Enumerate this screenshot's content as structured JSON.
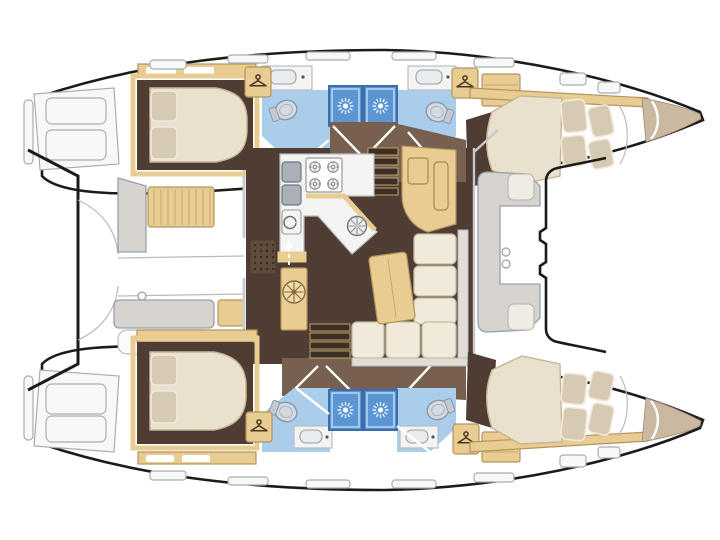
{
  "plan": {
    "title": "Catamaran interior layout plan - top view, bow to the right",
    "vessel_type": "sailing catamaran, 4-cabin / 4-bathroom layout",
    "orientation": {
      "bow": "right",
      "stern": "left",
      "top_hull": "port",
      "bottom_hull": "starboard"
    },
    "rooms": [
      {
        "id": "cabin-aft-port",
        "name": "Aft cabin (port hull)",
        "features": [
          "island double bed",
          "two pillows",
          "wardrobe",
          "hull windows"
        ]
      },
      {
        "id": "bathroom-aft-port",
        "name": "Aft bathroom (port hull)",
        "features": [
          "shower stall",
          "toilet",
          "washbasin"
        ]
      },
      {
        "id": "bathroom-fwd-port",
        "name": "Forward bathroom (port hull)",
        "features": [
          "shower stall",
          "toilet",
          "washbasin"
        ]
      },
      {
        "id": "cabin-fwd-port",
        "name": "Forward cabin (port hull)",
        "features": [
          "double bed",
          "four pillows",
          "wardrobe",
          "shelving",
          "forepeak locker"
        ]
      },
      {
        "id": "salon",
        "name": "Salon and galley",
        "features": [
          "L-shaped galley counter",
          "4-burner stove",
          "double sink",
          "round sink",
          "sideboard/fridge cabinet",
          "L-shaped sofa",
          "dining table",
          "companionway stairs to each hull",
          "sliding-door entry with floor grate"
        ]
      },
      {
        "id": "cabin-aft-starboard",
        "name": "Aft cabin (starboard hull)",
        "features": [
          "island double bed",
          "two pillows",
          "wardrobe",
          "hull windows"
        ]
      },
      {
        "id": "bathroom-aft-starboard",
        "name": "Aft bathroom (starboard hull)",
        "features": [
          "shower stall",
          "toilet",
          "washbasin"
        ]
      },
      {
        "id": "bathroom-fwd-starboard",
        "name": "Forward bathroom (starboard hull)",
        "features": [
          "shower stall",
          "toilet",
          "washbasin"
        ]
      },
      {
        "id": "cabin-fwd-starboard",
        "name": "Forward cabin (starboard hull)",
        "features": [
          "double bed",
          "four pillows",
          "wardrobe",
          "shelving",
          "forepeak locker"
        ]
      },
      {
        "id": "cockpit-aft",
        "name": "Aft cockpit",
        "features": [
          "upholstered bench",
          "lounge seat",
          "cockpit table",
          "transom steps"
        ]
      },
      {
        "id": "cockpit-fore",
        "name": "Forward cockpit",
        "features": [
          "C-shaped bench",
          "cup holders"
        ]
      },
      {
        "id": "trampoline",
        "name": "Foredeck trampoline area",
        "features": []
      }
    ],
    "icons": [
      {
        "name": "hanger-icon",
        "meaning": "wardrobe / hanging locker",
        "count": 4
      },
      {
        "name": "sun-icon",
        "meaning": "overhead shower head",
        "count": 4
      },
      {
        "name": "burner-icon",
        "meaning": "stove burner",
        "count": 4
      },
      {
        "name": "wheel-icon",
        "meaning": "round sink / round fixture",
        "count": 2
      }
    ],
    "colors": {
      "outline": "#1b1b1b",
      "hull_white": "#ffffff",
      "floor_dark": "#4f3d33",
      "floor_mid": "#77604f",
      "wood": "#e8cc92",
      "wood_edge": "#b2945e",
      "bed": "#e9e0cd",
      "pillow": "#d7cab2",
      "sofa": "#f0eadb",
      "bath_floor": "#a9cdea",
      "shower": "#5b96d2",
      "seat_gray": "#d7d3cf",
      "bow_beige": "#cab8a1",
      "counter": "#f4f4f2",
      "stair": "#3c2f26",
      "grate": "#5f4c3e",
      "toilet": "#d4dae2",
      "sketch": "#a9adb2"
    }
  }
}
